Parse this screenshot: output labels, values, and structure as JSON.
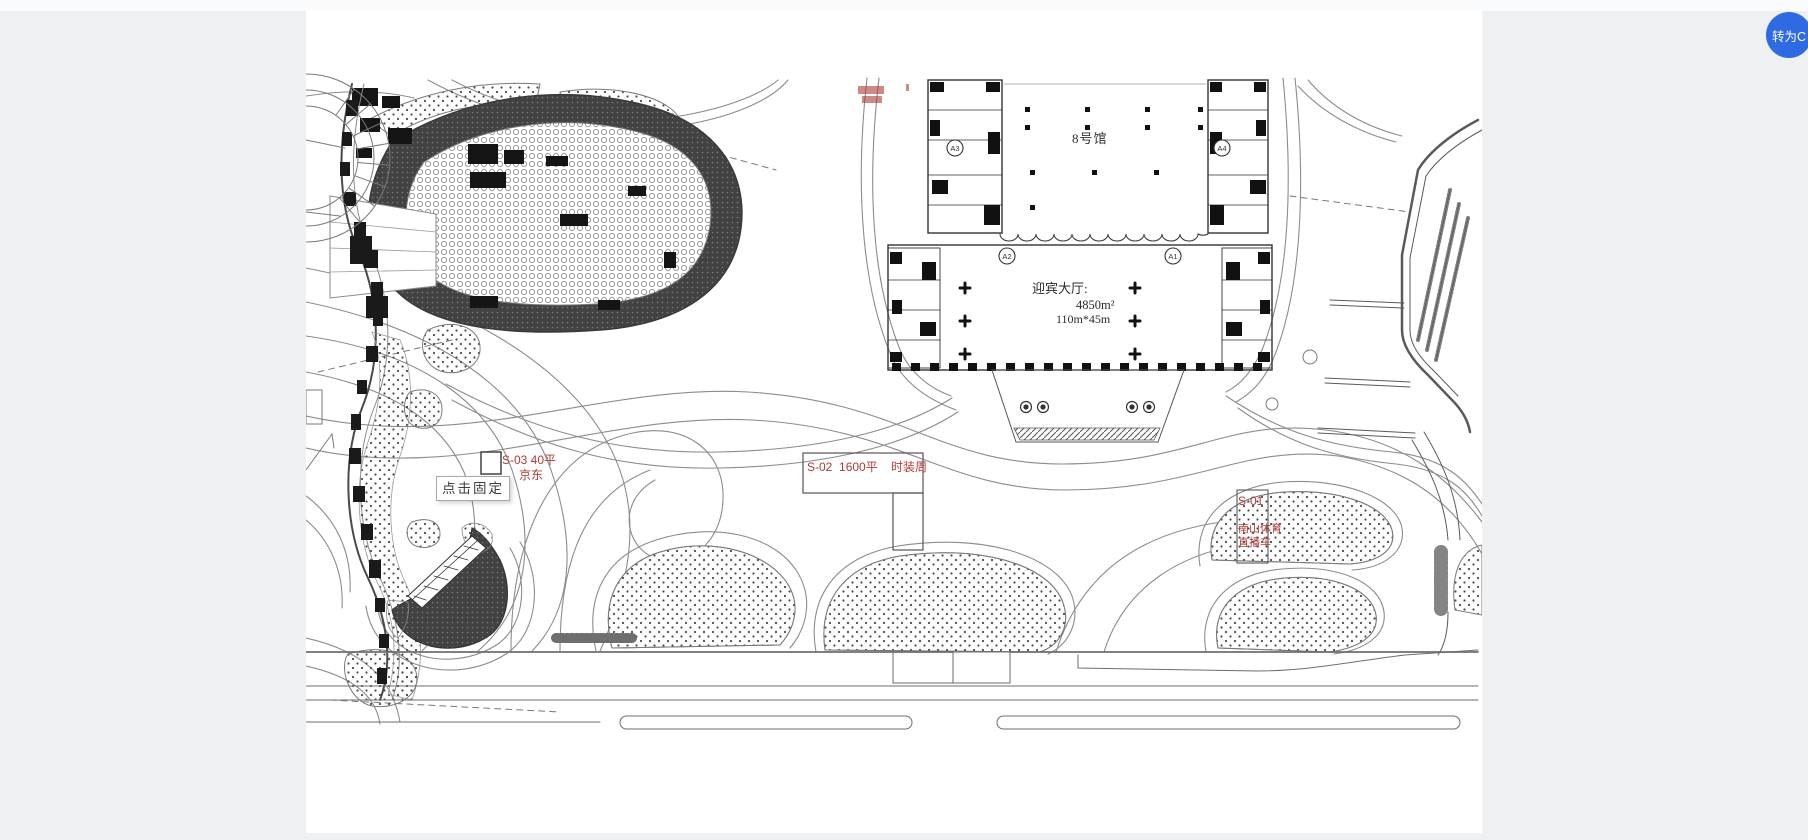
{
  "page": {
    "background": "#eef0f2",
    "canvas_background": "#ffffff"
  },
  "fab": {
    "label": "转为C",
    "color": "#2d6ae3"
  },
  "plan": {
    "hall8_label": "8号馆",
    "welcome_hall": {
      "title": "迎宾大厅:",
      "area": "4850m²",
      "dimensions": "110m*45m"
    },
    "axis_bubbles": {
      "a3": "A3",
      "a4": "A4",
      "a2": "A2",
      "a1": "A1"
    },
    "booth_s03": {
      "code_area": "S-03   40平",
      "name": "京东"
    },
    "booth_s02": {
      "text": "S-02  1600平    时装周"
    },
    "booth_s01": {
      "code": "S-01",
      "name_line1": "南山体育",
      "name_line2": "直播车"
    },
    "tooltip": {
      "text": "点击固定"
    },
    "colors": {
      "annotation_red": "#b03a34",
      "accent_blue": "#2d6ae3"
    }
  }
}
